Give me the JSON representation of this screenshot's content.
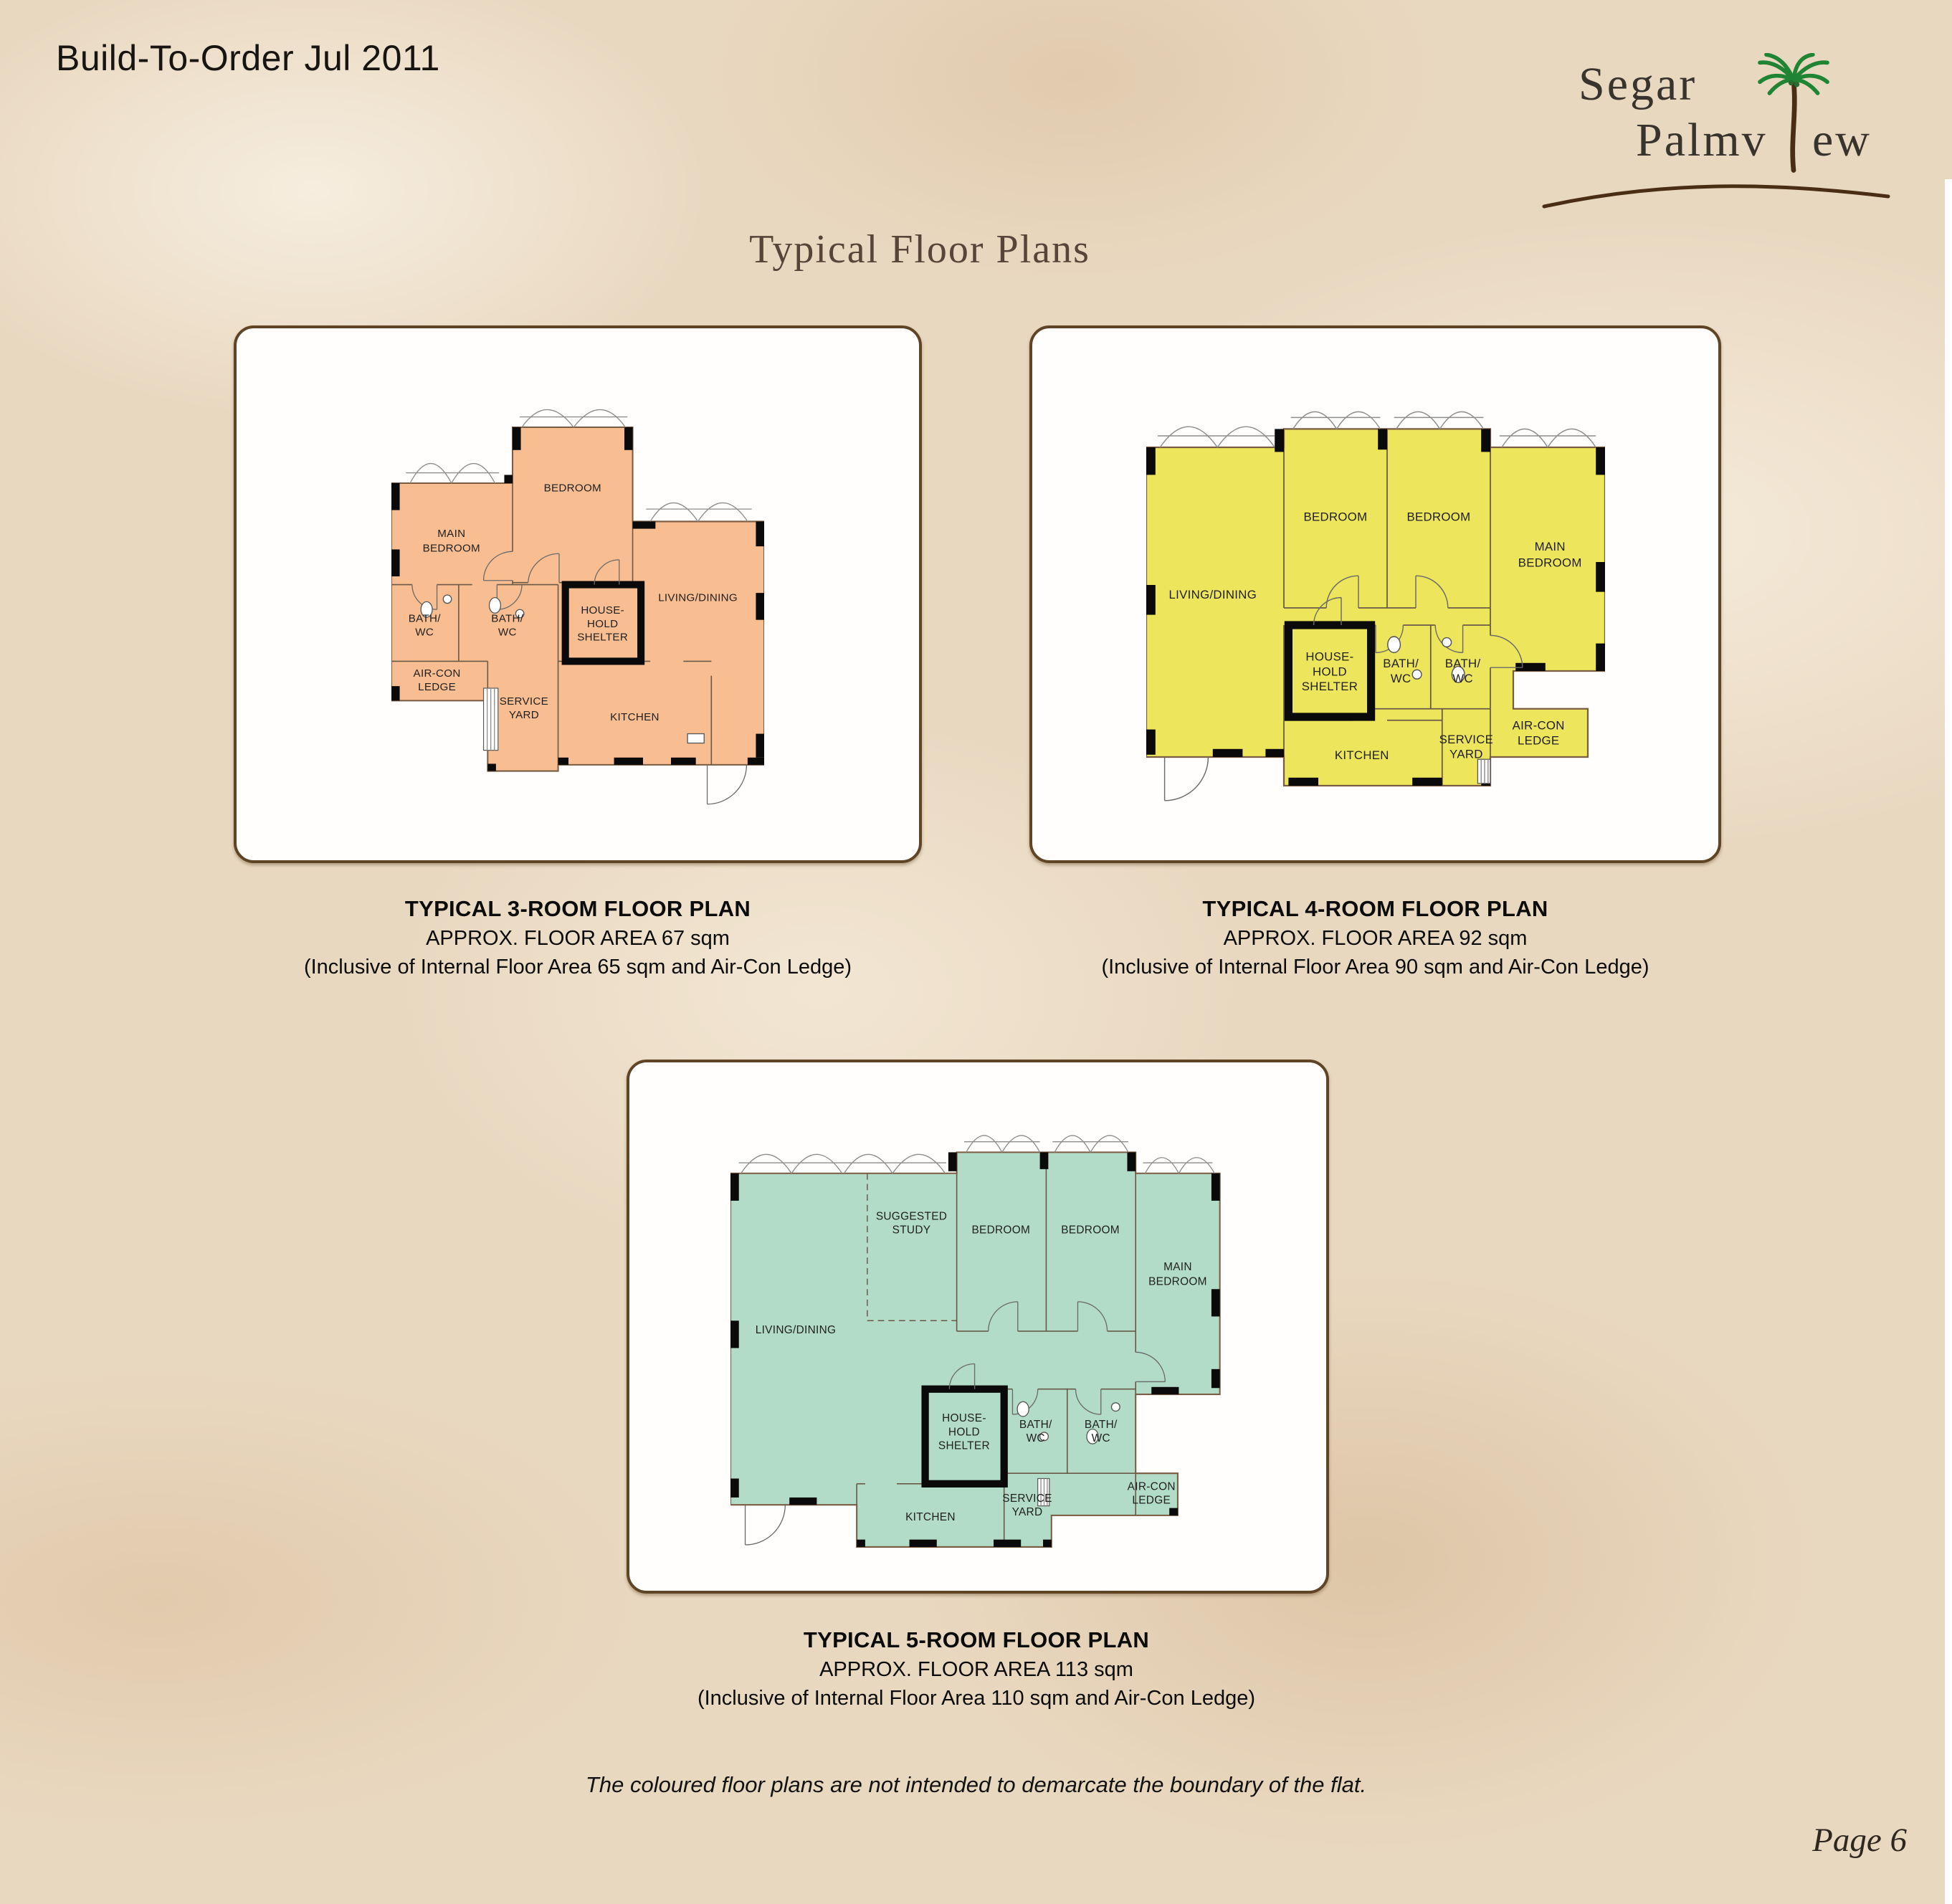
{
  "page": {
    "header_title": "Build-To-Order Jul 2011",
    "title": "Typical Floor Plans",
    "disclaimer": "The coloured floor plans are not intended to demarcate the boundary of the flat.",
    "page_number": "Page 6",
    "logo": {
      "word1": "Segar",
      "word2_left": "Palmv",
      "word2_right": "ew",
      "palm_icon": "palm-tree-icon",
      "colors": {
        "text": "#38332c",
        "palm_green": "#1f8434",
        "trunk_brown": "#4a2d15"
      }
    },
    "colors": {
      "background": "#e9d8c0",
      "card_border": "#5f4526",
      "title_brown": "#564538"
    }
  },
  "plans": [
    {
      "name": "3-room",
      "fill_color": "#f8bd90",
      "caption": {
        "line1": "TYPICAL 3-ROOM FLOOR PLAN",
        "line2": "APPROX. FLOOR AREA 67 sqm",
        "line3": "(Inclusive of Internal Floor Area 65 sqm and Air-Con Ledge)"
      },
      "rooms": {
        "main_bedroom": [
          "MAIN",
          "BEDROOM"
        ],
        "bedroom": [
          "BEDROOM"
        ],
        "living_dining": [
          "LIVING/DINING"
        ],
        "bath1": [
          "BATH/",
          "WC"
        ],
        "bath2": [
          "BATH/",
          "WC"
        ],
        "household_shelter": [
          "HOUSE-",
          "HOLD",
          "SHELTER"
        ],
        "aircon_ledge": [
          "AIR-CON",
          "LEDGE"
        ],
        "service_yard": [
          "SERVICE",
          "YARD"
        ],
        "kitchen": [
          "KITCHEN"
        ]
      }
    },
    {
      "name": "4-room",
      "fill_color": "#ede55c",
      "caption": {
        "line1": "TYPICAL 4-ROOM FLOOR PLAN",
        "line2": "APPROX. FLOOR AREA 92 sqm",
        "line3": "(Inclusive of Internal Floor Area 90 sqm and Air-Con Ledge)"
      },
      "rooms": {
        "living_dining": [
          "LIVING/DINING"
        ],
        "bedroom1": [
          "BEDROOM"
        ],
        "bedroom2": [
          "BEDROOM"
        ],
        "main_bedroom": [
          "MAIN",
          "BEDROOM"
        ],
        "household_shelter": [
          "HOUSE-",
          "HOLD",
          "SHELTER"
        ],
        "bath1": [
          "BATH/",
          "WC"
        ],
        "bath2": [
          "BATH/",
          "WC"
        ],
        "aircon_ledge": [
          "AIR-CON",
          "LEDGE"
        ],
        "service_yard": [
          "SERVICE",
          "YARD"
        ],
        "kitchen": [
          "KITCHEN"
        ]
      }
    },
    {
      "name": "5-room",
      "fill_color": "#b2dcc8",
      "caption": {
        "line1": "TYPICAL 5-ROOM FLOOR PLAN",
        "line2": "APPROX. FLOOR AREA 113 sqm",
        "line3": "(Inclusive of Internal Floor Area 110 sqm and Air-Con Ledge)"
      },
      "rooms": {
        "living_dining": [
          "LIVING/DINING"
        ],
        "suggested_study": [
          "SUGGESTED",
          "STUDY"
        ],
        "bedroom1": [
          "BEDROOM"
        ],
        "bedroom2": [
          "BEDROOM"
        ],
        "main_bedroom": [
          "MAIN",
          "BEDROOM"
        ],
        "household_shelter": [
          "HOUSE-",
          "HOLD",
          "SHELTER"
        ],
        "bath1": [
          "BATH/",
          "WC"
        ],
        "bath2": [
          "BATH/",
          "WC"
        ],
        "aircon_ledge": [
          "AIR-CON",
          "LEDGE"
        ],
        "service_yard": [
          "SERVICE",
          "YARD"
        ],
        "kitchen": [
          "KITCHEN"
        ]
      }
    }
  ]
}
